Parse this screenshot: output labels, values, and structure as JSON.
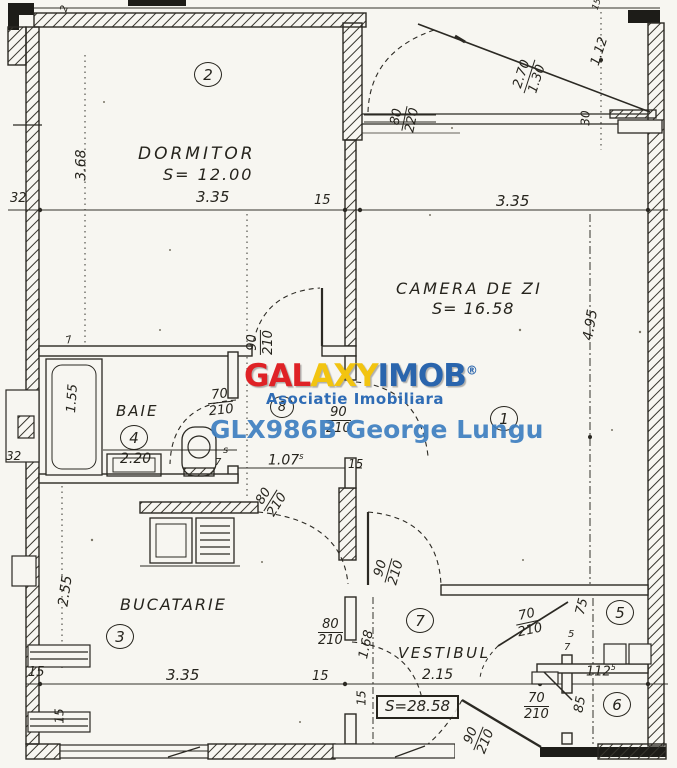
{
  "watermark": {
    "brand_part1": "GAL",
    "brand_part2": "AXY",
    "brand_part3": "IMOB",
    "brand_reg": "®",
    "subtitle": "Asociatie Imobiliara",
    "agent": "GLX986B George Lungu",
    "color_red": "#df2226",
    "color_yellow": "#f2c410",
    "color_blue": "#2a65ad"
  },
  "total_area": "S=28.58",
  "rooms": {
    "living": {
      "number": "1",
      "name": "CAMERA DE ZI",
      "area": "S= 16.58"
    },
    "bedroom": {
      "number": "2",
      "name": "DORMITOR",
      "area": "S= 12.00"
    },
    "kitchen": {
      "number": "3",
      "name": "BUCATARIE"
    },
    "bath": {
      "number": "4",
      "name": "BAIE"
    },
    "closet5": {
      "number": "5"
    },
    "closet6": {
      "number": "6"
    },
    "hallway": {
      "number": "7",
      "name": "VESTIBUL"
    },
    "wc": {
      "number": "8"
    }
  },
  "dims": {
    "bedroom_width": "3.35",
    "gap15_a": "15",
    "living_width": "3.35",
    "bedroom_height": "3.68",
    "wall32_top": "32",
    "tick2": "2",
    "balcony_win": {
      "num": "2.70",
      "den": "1.30"
    },
    "balcony_side": "1.12",
    "tick15_tr": "15",
    "radiator30": "30",
    "living_height": "4.95",
    "bath_len": "1.55",
    "bath_w": "2.20",
    "wall32_mid": "32",
    "hall_w": "1.07",
    "hall_w_sup": "s",
    "gap15_b": "15",
    "kitchen_h": "2.55",
    "k15a": "15",
    "kitchen_w": "3.35",
    "k15b": "15",
    "win15": "15",
    "vest15": "15",
    "vest_h": "1.68",
    "vest_w": "2.15",
    "c5_w": "75",
    "c6_w": "85",
    "niche_w": "112",
    "niche_w_sup": "5"
  },
  "ticks": {
    "s1": "s",
    "n7a": "7",
    "n7b": "7",
    "n5a": "5",
    "n7c": "7"
  },
  "doors": {
    "balcony": {
      "num": "80",
      "den": "220"
    },
    "bedroom": {
      "num": "90",
      "den": "210"
    },
    "bath": {
      "num": "70",
      "den": "210"
    },
    "living": {
      "num": "90",
      "den": "210"
    },
    "kitchen": {
      "num": "80",
      "den": "210"
    },
    "vest_kitchen": {
      "num": "80",
      "den": "210"
    },
    "vest_living": {
      "num": "90",
      "den": "210"
    },
    "closet5": {
      "num": "70",
      "den": "210"
    },
    "closet6": {
      "num": "70",
      "den": "210"
    },
    "entry": {
      "num": "90",
      "den": "210"
    }
  }
}
